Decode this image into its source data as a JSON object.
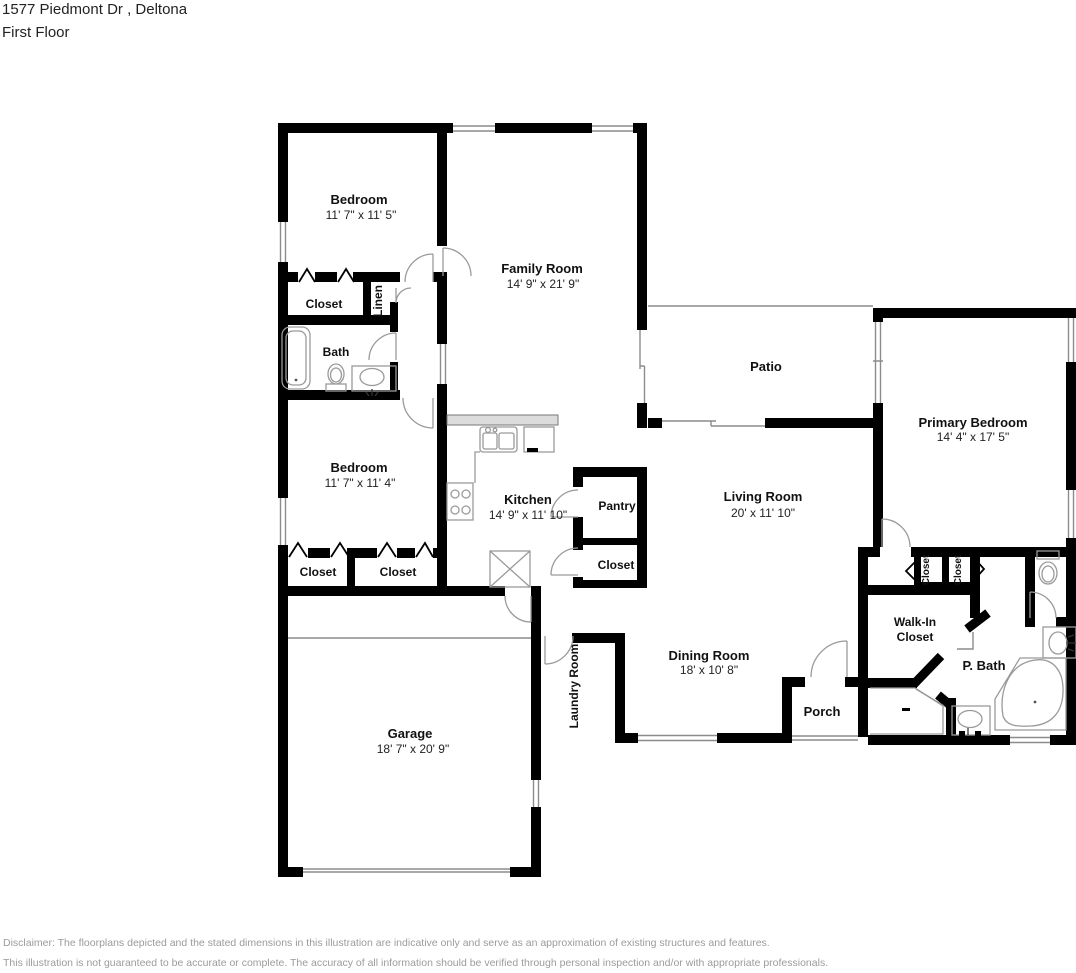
{
  "header": {
    "address": "1577 Piedmont Dr , Deltona",
    "floor": "First Floor"
  },
  "rooms": {
    "bedroom1": {
      "name": "Bedroom",
      "dims": "11' 7\" x 11' 5\""
    },
    "family": {
      "name": "Family Room",
      "dims": "14' 9\" x 21' 9\""
    },
    "closet_bd1": {
      "name": "Closet"
    },
    "linen": {
      "name": "Linen"
    },
    "bath": {
      "name": "Bath"
    },
    "bedroom2": {
      "name": "Bedroom",
      "dims": "11' 7\" x 11' 4\""
    },
    "kitchen": {
      "name": "Kitchen",
      "dims": "14' 9\" x 11' 10\""
    },
    "pantry": {
      "name": "Pantry"
    },
    "closet_pantry": {
      "name": "Closet"
    },
    "closet_bd2a": {
      "name": "Closet"
    },
    "closet_bd2b": {
      "name": "Closet"
    },
    "patio": {
      "name": "Patio"
    },
    "living": {
      "name": "Living Room",
      "dims": "20' x 11' 10\""
    },
    "primary": {
      "name": "Primary Bedroom",
      "dims": "14' 4\" x 17' 5\""
    },
    "closet_p1": {
      "name": "Closet"
    },
    "closet_p2": {
      "name": "Closet"
    },
    "walkin": {
      "line1": "Walk-In",
      "line2": "Closet"
    },
    "pbath": {
      "name": "P. Bath"
    },
    "dining": {
      "name": "Dining Room",
      "dims": "18' x 10' 8\""
    },
    "porch": {
      "name": "Porch"
    },
    "garage": {
      "name": "Garage",
      "dims": "18' 7\" x 20' 9\""
    },
    "laundry": {
      "name": "Laundry Room"
    }
  },
  "disclaimer": {
    "line1": "Disclaimer: The floorplans depicted and the stated dimensions in this illustration are indicative only and serve as an approximation of existing structures and features.",
    "line2": "This illustration is not guaranteed to be accurate or complete. The accuracy of all information should be verified through personal inspection and/or with appropriate professionals."
  },
  "colors": {
    "wall": "#000000",
    "thin_line": "#8c8c8c",
    "counter_fill": "#dcdcdc",
    "label": "#111111",
    "disclaimer_text": "#9b9b9b"
  }
}
